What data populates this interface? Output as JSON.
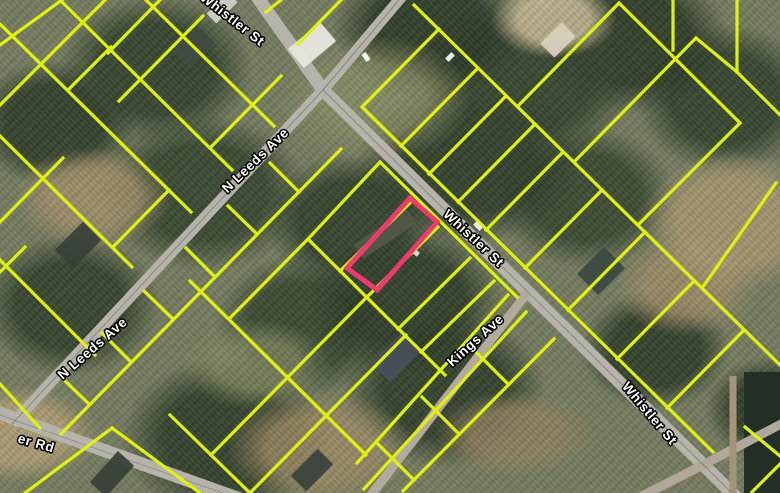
{
  "map": {
    "colors": {
      "parcel_line": "#dff20e",
      "highlight": "#ee3a6e",
      "road": "#b5b3aa",
      "label_fill": "#ffffff",
      "label_halo": "#000000",
      "water": "#232f25"
    },
    "street_labels": [
      {
        "text": "Whistler St",
        "x": 232,
        "y": 20,
        "rot": 38
      },
      {
        "text": "Whistler St",
        "x": 473,
        "y": 239,
        "rot": 43
      },
      {
        "text": "Whistler St",
        "x": 649,
        "y": 414,
        "rot": 50
      },
      {
        "text": "N Leeds Ave",
        "x": 256,
        "y": 161,
        "rot": -44
      },
      {
        "text": "N Leeds Ave",
        "x": 93,
        "y": 349,
        "rot": -41
      },
      {
        "text": "Kings Ave",
        "x": 476,
        "y": 341,
        "rot": -42
      },
      {
        "text": "er Rd",
        "x": 36,
        "y": 444,
        "rot": 16
      }
    ],
    "roads": [
      {
        "name": "whistler-st",
        "pts": [
          [
            255,
            -6
          ],
          [
            323,
            90
          ],
          [
            738,
            499
          ]
        ],
        "w": 13,
        "c": "#b5b3aa"
      },
      {
        "name": "n-leeds-ave",
        "pts": [
          [
            404,
            -6
          ],
          [
            323,
            90
          ],
          [
            12,
            424
          ]
        ],
        "w": 11,
        "c": "#b5b3aa"
      },
      {
        "name": "er-rd",
        "pts": [
          [
            -6,
            411
          ],
          [
            240,
            499
          ]
        ],
        "w": 13,
        "c": "#b5b3aa"
      },
      {
        "name": "kings-ave",
        "pts": [
          [
            528,
            292
          ],
          [
            368,
            499
          ]
        ],
        "w": 9,
        "c": "#b2ab9d"
      },
      {
        "name": "crossroad-se",
        "pts": [
          [
            783,
            423
          ],
          [
            703,
            465
          ],
          [
            636,
            499
          ]
        ],
        "w": 9,
        "c": "#b0a899"
      },
      {
        "name": "dirt-lane-east",
        "pts": [
          [
            733,
            376
          ],
          [
            733,
            499
          ]
        ],
        "w": 7,
        "c": "#a3957a"
      },
      {
        "name": "wire-whistler",
        "pts": [
          [
            323,
            90
          ],
          [
            738,
            499
          ]
        ],
        "w": 1,
        "c": "#6b6a62",
        "o": 0.6
      },
      {
        "name": "wire-n-leeds",
        "pts": [
          [
            404,
            -6
          ],
          [
            323,
            90
          ],
          [
            12,
            424
          ]
        ],
        "w": 1,
        "c": "#6b6a62",
        "o": 0.6
      },
      {
        "name": "wire-er-rd",
        "pts": [
          [
            -6,
            413
          ],
          [
            240,
            499
          ]
        ],
        "w": 1,
        "c": "#6f6d65",
        "o": 0.5
      }
    ],
    "water": {
      "x": 744,
      "y": 372,
      "w": 36,
      "h": 121
    },
    "buildings": [
      {
        "x": 312,
        "y": 45,
        "w": 42,
        "h": 25,
        "rot": -40,
        "c": "#e9e6df"
      },
      {
        "x": 558,
        "y": 40,
        "w": 30,
        "h": 20,
        "rot": -45,
        "c": "#d8d0bb"
      },
      {
        "x": 222,
        "y": 8,
        "w": 30,
        "h": 14,
        "rot": -45,
        "c": "#cdd0c9"
      },
      {
        "x": 194,
        "y": 46,
        "w": 34,
        "h": 24,
        "rot": -45,
        "c": "#414a41"
      },
      {
        "x": 385,
        "y": 234,
        "w": 64,
        "h": 17,
        "rot": -34,
        "c": "#525747"
      },
      {
        "x": 601,
        "y": 271,
        "w": 38,
        "h": 30,
        "rot": -45,
        "c": "#3c4a45"
      },
      {
        "x": 78,
        "y": 245,
        "w": 40,
        "h": 26,
        "rot": -45,
        "c": "#39413a"
      },
      {
        "x": 112,
        "y": 474,
        "w": 42,
        "h": 22,
        "rot": -48,
        "c": "#39413a"
      },
      {
        "x": 396,
        "y": 357,
        "w": 44,
        "h": 27,
        "rot": -45,
        "c": "#46505a"
      },
      {
        "x": 312,
        "y": 470,
        "w": 38,
        "h": 22,
        "rot": -45,
        "c": "#3a423b"
      }
    ],
    "cars": [
      {
        "x": 366,
        "y": 57,
        "rot": 55,
        "c": "#f4f4f0"
      },
      {
        "x": 450,
        "y": 57,
        "rot": -45,
        "c": "#eeeee8"
      },
      {
        "x": 478,
        "y": 226,
        "rot": 45,
        "c": "#f2f2ec"
      },
      {
        "x": 415,
        "y": 252,
        "rot": 40,
        "c": "#d8d8d2"
      }
    ],
    "parcel_lines": [
      [
        146,
        0,
        274,
        126
      ],
      [
        60,
        0,
        232,
        170
      ],
      [
        0,
        24,
        191,
        212
      ],
      [
        0,
        136,
        132,
        267
      ],
      [
        0,
        260,
        95,
        355
      ],
      [
        0,
        384,
        40,
        428
      ],
      [
        281,
        76,
        211,
        147
      ],
      [
        169,
        190,
        113,
        247
      ],
      [
        203,
        16,
        119,
        101
      ],
      [
        63,
        158,
        0,
        222
      ],
      [
        111,
        47,
        69,
        89
      ],
      [
        62,
        0,
        0,
        45
      ],
      [
        25,
        247,
        0,
        272
      ],
      [
        105,
        0,
        0,
        105
      ],
      [
        160,
        0,
        108,
        53
      ],
      [
        341,
        149,
        61,
        434
      ],
      [
        270,
        163,
        299,
        192
      ],
      [
        228,
        206,
        257,
        234
      ],
      [
        186,
        248,
        215,
        277
      ],
      [
        144,
        291,
        173,
        319
      ],
      [
        102,
        333,
        131,
        362
      ],
      [
        60,
        376,
        89,
        404
      ],
      [
        380,
        162,
        517,
        297
      ],
      [
        308,
        239,
        445,
        375
      ],
      [
        380,
        162,
        308,
        239
      ],
      [
        412,
        201,
        340,
        271
      ],
      [
        438,
        227,
        367,
        297
      ],
      [
        470,
        258,
        398,
        329
      ],
      [
        494,
        281,
        421,
        352
      ],
      [
        190,
        281,
        366,
        455
      ],
      [
        308,
        239,
        229,
        319
      ],
      [
        367,
        297,
        288,
        377
      ],
      [
        406,
        335,
        327,
        415
      ],
      [
        170,
        415,
        250,
        493
      ],
      [
        288,
        377,
        211,
        455
      ],
      [
        327,
        415,
        250,
        493
      ],
      [
        554,
        339,
        403,
        491
      ],
      [
        471,
        347,
        508,
        384
      ],
      [
        422,
        397,
        459,
        434
      ],
      [
        377,
        443,
        414,
        480
      ],
      [
        508,
        295,
        357,
        463
      ],
      [
        526,
        312,
        364,
        489
      ],
      [
        362,
        107,
        713,
        452
      ],
      [
        414,
        5,
        780,
        365
      ],
      [
        362,
        107,
        439,
        29
      ],
      [
        401,
        146,
        478,
        68
      ],
      [
        429,
        174,
        506,
        96
      ],
      [
        458,
        202,
        535,
        124
      ],
      [
        486,
        230,
        563,
        152
      ],
      [
        525,
        268,
        602,
        190
      ],
      [
        568,
        310,
        645,
        232
      ],
      [
        617,
        359,
        694,
        281
      ],
      [
        667,
        408,
        744,
        330
      ],
      [
        518,
        106,
        619,
        3
      ],
      [
        574,
        162,
        696,
        38
      ],
      [
        638,
        225,
        740,
        123
      ],
      [
        702,
        288,
        776,
        183
      ],
      [
        619,
        3,
        740,
        123
      ],
      [
        673,
        0,
        673,
        50
      ],
      [
        737,
        0,
        737,
        72
      ],
      [
        737,
        72,
        780,
        115
      ],
      [
        696,
        38,
        737,
        72
      ],
      [
        298,
        44,
        341,
        0
      ],
      [
        266,
        12,
        281,
        0
      ],
      [
        752,
        492,
        780,
        464
      ],
      [
        745,
        427,
        780,
        456
      ],
      [
        25,
        493,
        112,
        428
      ],
      [
        112,
        428,
        200,
        493
      ]
    ],
    "highlight_parcel": {
      "points": [
        [
          410,
          198
        ],
        [
          437,
          222
        ],
        [
          377,
          290
        ],
        [
          347,
          268
        ]
      ]
    }
  }
}
